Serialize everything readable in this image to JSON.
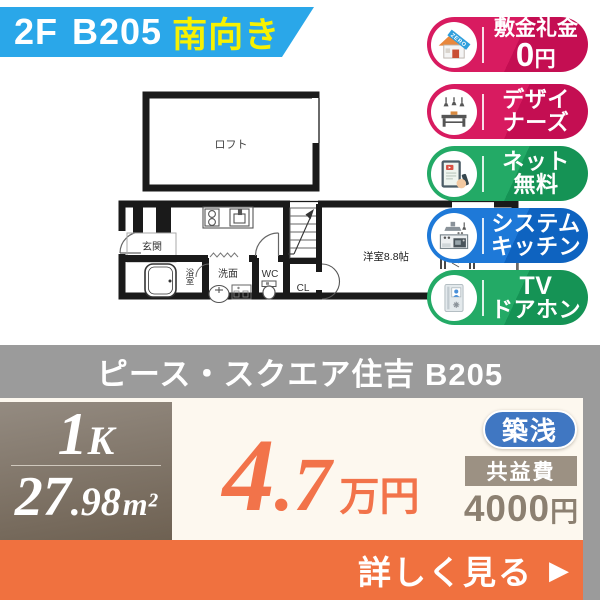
{
  "ribbon": {
    "floor": "2F",
    "unit": "B205",
    "facing": "南向き"
  },
  "floorplan": {
    "loft": "ロフト",
    "entrance": "玄関",
    "bath": "浴室",
    "washroom": "洗面",
    "toilet": "WC",
    "closet": "CL",
    "main_room": "洋室8.8帖"
  },
  "feature_badges": [
    {
      "id": "zero-deposit",
      "line1": "敷金礼金",
      "zero": "0",
      "zero_unit": "円",
      "color_light": "#d81b60",
      "color_dark": "#c40e52"
    },
    {
      "id": "designers",
      "line1": "デザイ",
      "line2": "ナーズ",
      "color_light": "#d81b60",
      "color_dark": "#c40e52"
    },
    {
      "id": "free-internet",
      "line1": "ネット",
      "line2": "無料",
      "color_light": "#23aa66",
      "color_dark": "#159355"
    },
    {
      "id": "system-kitchen",
      "line1": "システム",
      "line2": "キッチン",
      "color_light": "#1e79d8",
      "color_dark": "#0e63c0"
    },
    {
      "id": "tv-doorphone",
      "line1": "TV",
      "line2": "ドアホン",
      "color_light": "#23aa66",
      "color_dark": "#159355"
    }
  ],
  "title_bar": {
    "property_name": "ピース・スクエア住吉 B205"
  },
  "summary": {
    "layout": {
      "big": "1",
      "small": "K"
    },
    "area": {
      "int": "27",
      "dec": ".98",
      "unit": "m²"
    },
    "rent": {
      "int": "4",
      "dec": ".7",
      "unit": "万円"
    },
    "age_badge": "築浅",
    "fee": {
      "label": "共益費",
      "value": "4000",
      "unit": "円"
    }
  },
  "cta": {
    "label": "詳しく見る",
    "arrow": "▶"
  },
  "colors": {
    "ribbon_blue": "#2aa7e9",
    "ribbon_yellow": "#f6f102",
    "badge_pink": "#d81b60",
    "badge_green": "#23aa66",
    "badge_blue": "#1e79d8",
    "bar_gray": "#9b9b9b",
    "price_orange": "#f2734a",
    "cta_orange": "#f0713f",
    "layout_box_top": "#948b81",
    "layout_box_bottom": "#6e6152",
    "age_badge_blue": "#4077c2",
    "fee_label_bg": "#9c9183",
    "fee_text": "#8c8071",
    "bottom_cream": "#fdf8ef"
  }
}
